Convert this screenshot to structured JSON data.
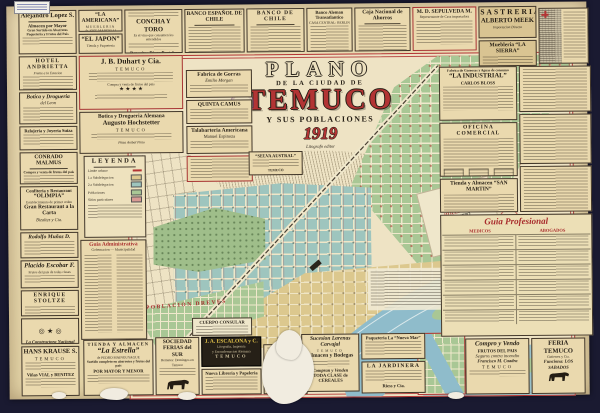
{
  "title_block": {
    "t1": "PLANO",
    "t2": "DE LA CIUDAD DE",
    "t3": "TEMUCO",
    "t4": "Y SUS POBLACIONES",
    "year": "1919",
    "subtitle": "Litografo editor"
  },
  "legend": {
    "title": "LEYENDA",
    "items": [
      {
        "label": "Limite urbano",
        "color": "#b23434"
      },
      {
        "label": "1.a Subdelegacion",
        "color": "#ddc88e"
      },
      {
        "label": "2.a Subdelegacion",
        "color": "#9ec5be"
      },
      {
        "label": "Poblaciones",
        "color": "#a9c795"
      },
      {
        "label": "Sitios particulares",
        "color": "#d89a93"
      }
    ]
  },
  "map_labels": {
    "dreves": "POBLACION DREVES",
    "hijuela_line1": "HIJUELA 77-B",
    "hijuela_line2": "del CERRO",
    "river": "Rio Cautin",
    "consular": "CUERPO CONSULAR"
  },
  "colors": {
    "teal_district": "#9ec5be",
    "green_district": "#a9c795",
    "yellow_district": "#dcc88e",
    "river": "#8fbccb",
    "accent_red": "#b23434",
    "paper": "#e8d9b0",
    "mat": "#1a1a31"
  },
  "ads": {
    "alejandro_lopez": {
      "title": "Alejandro Lopez S.",
      "l1": "Almacen por Mayor",
      "l2": "Gran Surtido en Abarrotes",
      "l3": "Paqueteria y Frutos del Pais"
    },
    "la_americana": {
      "title": "“LA AMERICANA”",
      "l1": "MUEBLERIA",
      "l2": "de JOSE MARCELLI"
    },
    "el_japon": {
      "title": "“EL JAPON”",
      "l1": "Tienda y Paqueteria"
    },
    "concha_y_toro": {
      "title": "CONCHA Y TORO",
      "l1": "Es el vino que consumen los entendidos",
      "l2": "Deposito: Diego Portales 665"
    },
    "banco_espanol": {
      "title": "BANCO ESPAÑOL DE CHILE"
    },
    "banco_chile": {
      "title": "BANCO DE CHILE"
    },
    "banco_aleman": {
      "title": "Banco Aleman Transatlantico",
      "l1": "CASA CENTRAL: BERLIN"
    },
    "caja_ahorros": {
      "title": "Caja Nacional de Ahorros"
    },
    "sepulveda": {
      "title": "M. D. SEPULVEDA M.",
      "l1": "Representante de Casa importadora"
    },
    "sastreria_meek": {
      "t1": "SASTRERIA",
      "t2": "ALBERTO MEEK",
      "l1": "Importacion Directa"
    },
    "la_sierra": {
      "title": "Muebleria “LA SIERRA”"
    },
    "la_industrial": {
      "pre": "Fabrica de Gaseosas y Aguas de consumo",
      "title": "“LA INDUSTRIAL”",
      "l1": "CARLOS BLOSS"
    },
    "oficina_comercial": {
      "title": "OFICINA COMERCIAL"
    },
    "san_martin": {
      "title": "Tienda y Almacen “SAN MARTIN”"
    },
    "guia_profesional": {
      "title": "Guia Profesional",
      "col1": "MEDICOS",
      "col2": "ABOGADOS"
    },
    "hotel_andrietta": {
      "title": "HOTEL ANDRIETTA",
      "l1": "Frente a la Estacion"
    },
    "botica_leon": {
      "title": "Botica y Drogueria",
      "l1": "del Leon"
    },
    "relojeria_suiza": {
      "title": "Relojeria y Joyeria Suiza"
    },
    "conrado_malmus": {
      "title": "CONRADO MALMUS",
      "l1": "Compra y venta de frutos del pais"
    },
    "olimpia": {
      "t1": "Confiteria y Restaurant",
      "t2": "“OLIMPIA”",
      "l1": "Establecimiento de primer orden",
      "l2": "Gran Restaurant a la Carta",
      "l3": "Bizaltez y Cia."
    },
    "rodolfo_munoz": {
      "title": "Rodolfo Muñoz D."
    },
    "placido_escobar": {
      "title": "Placido Escobar F.",
      "l1": "Frutos del pais de todas clases"
    },
    "enrique_stoltze": {
      "title": "ENRIQUE STOLTZE"
    },
    "constructora": {
      "title": "La Constructora Nacional"
    },
    "hans_krause": {
      "title": "HANS KRAUSE S.",
      "l1": "TEMUCO",
      "l2": "Viñas VIAL y BENITEZ"
    },
    "duhart": {
      "title": "J. B. Duhart y Cia.",
      "l1": "TEMUCO",
      "l2": "Compra y venta de frutos del pais",
      "stars": "★ ★ ★ ★"
    },
    "hochstetter": {
      "title": "Botica y Drogueria Alemana",
      "name": "Augusto Hochstetter",
      "l1": "TEMUCO",
      "l2": "Plaza Anibal Pinto"
    },
    "la_estrella": {
      "pre": "TIENDA Y ALMACEN",
      "title": "“La Estrella”",
      "l1": "de PEDRO MAINGUYAGUE",
      "l2": "Surtido completo en abarrotes y frutos del pais",
      "l3": "POR MAYOR Y MENOR"
    },
    "ferias_sur": {
      "t1": "SOCIEDAD",
      "t2": "FERIAS del SUR",
      "l1": "Remates: Domingos en Temuco"
    },
    "imprenta": {
      "title": "J. A. ESCALONA y C.",
      "l1": "Litografia, Imprenta",
      "l2": "y Encuadernacion Alemana",
      "l3": "TEMUCO"
    },
    "nueva_libreria": {
      "title": "Nueva Libreria y Papeleria"
    },
    "larenas": {
      "title": "Sucesion Larenas Carvajal",
      "l1": "TEMUCO",
      "l2": "Almacen y Bodegas",
      "l3": "Compran y Venden",
      "l4": "TODA CLASE de CEREALES"
    },
    "nueva_mar": {
      "title": "Paqueteria La “Nueva Mar”"
    },
    "jardinera": {
      "title": "LA JARDINERA",
      "l1": "Riess y Cia."
    },
    "compro_vendo": {
      "t1": "Compro y Vendo",
      "l1": "FRUTOS DEL PAIS",
      "l2": "Seguros contra incendio",
      "l3": "Francisco M. Cuadra",
      "l4": "TEMUCO"
    },
    "feria_temuco": {
      "title": "FERIA TEMUCO",
      "l1": "Gutierrez y Cia.",
      "l2": "Funciona: LOS SABADOS"
    },
    "gorras": {
      "title": "Fabrica de Gorras",
      "l1": "Emilio Morgan"
    },
    "quinta": {
      "title": "QUINTA CAMUS"
    },
    "talabarteria": {
      "title": "Talabarteria Americana",
      "l1": "Manuel Espinoza"
    },
    "selva_austral": {
      "title": "“SELVA AUSTRAL”",
      "l1": "TEMUCO"
    },
    "guia_admin": {
      "title": "Guia Administrativa",
      "l1": "Gobernacion — Municipalidad"
    }
  }
}
